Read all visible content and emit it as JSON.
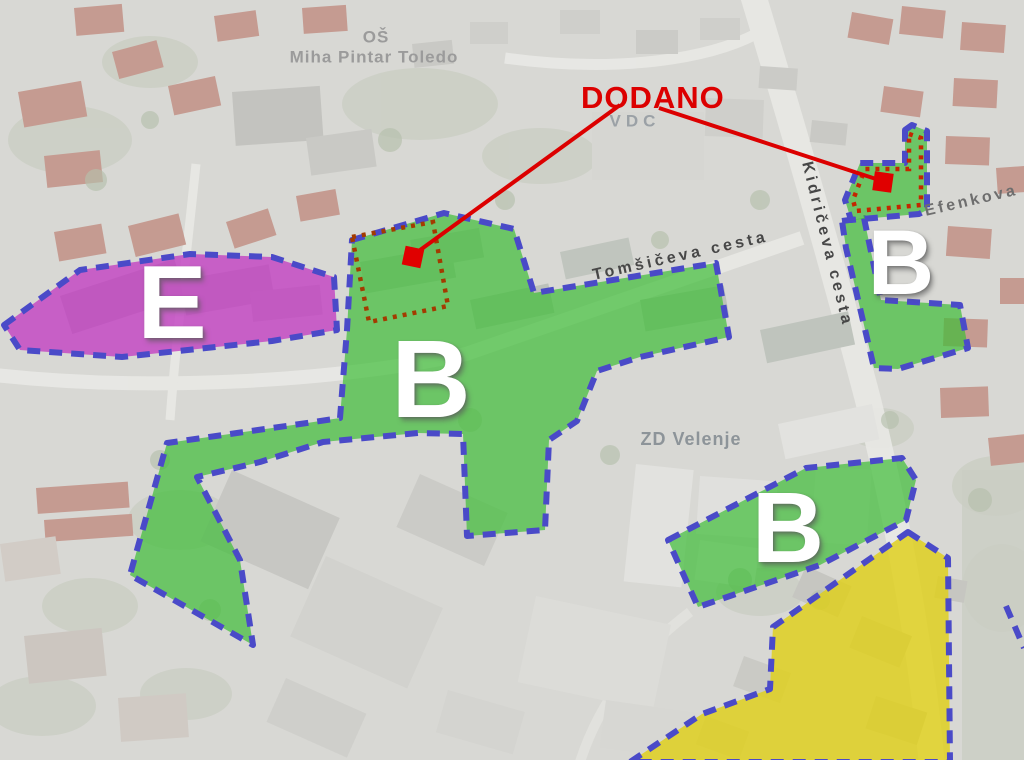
{
  "map": {
    "background_color": "#d8d8d4",
    "border_color": "#4a4ac8",
    "zone_colors": {
      "business_green": "#3fbe38",
      "energy_purple": "#c23cc2",
      "residential_yellow": "#e0d014"
    },
    "annotation": {
      "title": "DODANO",
      "color": "#dc0000",
      "dotted_rect_color": "#a33b00",
      "dotted_rect_points": "352,237 433,222 448,306 369,322",
      "lines": [
        {
          "x1": 620,
          "y1": 105,
          "x2": 416,
          "y2": 253
        },
        {
          "x1": 659,
          "y1": 108,
          "x2": 876,
          "y2": 179
        }
      ],
      "markers": [
        {
          "x": 413,
          "y": 257,
          "size": 19,
          "rotation": 12
        },
        {
          "x": 883,
          "y": 182,
          "size": 19,
          "rotation": 8
        }
      ]
    },
    "zones": [
      {
        "id": "zone-e",
        "letter": "E",
        "fill": "#c23cc2",
        "opacity": 0.78,
        "points": "4,325 80,270 190,254 272,257 334,277 337,330 272,341 122,357 20,350",
        "letter_x": 172,
        "letter_y": 303,
        "letter_size": 104
      },
      {
        "id": "zone-b-central",
        "letter": "B",
        "fill": "#3fbe38",
        "opacity": 0.7,
        "points": "352,240 444,213 514,229 534,293 716,263 729,337 640,357 597,371 577,421 549,440 545,530 467,536 463,434 418,433 323,442 260,462 197,477 240,560 253,645 130,575 167,443 307,423 340,418 347,330",
        "letter_x": 431,
        "letter_y": 380,
        "letter_size": 110
      },
      {
        "id": "zone-b-east",
        "letter": "B",
        "fill": "#3fbe38",
        "opacity": 0.7,
        "points": "842,221 864,218 881,300 960,305 968,348 898,369 874,368 846,248",
        "letter_x": 901,
        "letter_y": 263,
        "letter_size": 92
      },
      {
        "id": "zone-b-south",
        "letter": "B",
        "fill": "#3fbe38",
        "opacity": 0.7,
        "points": "668,540 806,468 902,458 916,480 906,520 820,565 698,607",
        "letter_x": 788,
        "letter_y": 528,
        "letter_size": 100
      },
      {
        "id": "zone-dodano",
        "letter": "",
        "fill": "#3fbe38",
        "opacity": 0.7,
        "points": "905,130 912,125 927,131 927,210 919,214 851,220 845,200 860,163 905,163",
        "inner_dotted": "909,134 921,138 921,205 856,211 853,200 865,169 909,169",
        "inner_dotted_color": "#c32700"
      },
      {
        "id": "zone-yellow",
        "letter": "",
        "fill": "#e0d014",
        "opacity": 0.8,
        "points": "908,532 948,558 950,762 630,762 702,714 770,689 773,627"
      }
    ],
    "extra_borders": [
      {
        "id": "edge-zone-corner",
        "points": "1006,606 1024,648"
      }
    ],
    "street_labels": [
      {
        "text": "Tomšičeva cesta",
        "x": 593,
        "y": 276,
        "rotation": -12.5,
        "size": 16,
        "spacing": 3.5,
        "color": "#474747"
      },
      {
        "text": "Kidričeva cesta",
        "x": 806,
        "y": 162,
        "rotation": 76,
        "size": 16,
        "spacing": 3.5,
        "color": "#474747"
      },
      {
        "text": "Efenkova",
        "x": 925,
        "y": 212,
        "rotation": -13,
        "size": 16,
        "spacing": 3,
        "color": "#6e6e6e"
      }
    ],
    "place_labels": [
      {
        "id": "school-name-line1",
        "text": "OŠ",
        "x": 376,
        "y": 37,
        "size": 17,
        "spacing": 1,
        "color": "#9b9b9b"
      },
      {
        "id": "school-name-line2",
        "text": "Miha Pintar Toledo",
        "x": 374,
        "y": 57,
        "size": 17,
        "spacing": 1,
        "color": "#9b9b9b"
      },
      {
        "id": "vdc-label",
        "text": "VDC",
        "x": 635,
        "y": 121,
        "size": 17,
        "spacing": 5,
        "color": "#9ba1a6"
      },
      {
        "id": "zd-velenje-label",
        "text": "ZD Velenje",
        "x": 691,
        "y": 439,
        "size": 18,
        "spacing": 1,
        "color": "#8d9499"
      }
    ]
  }
}
